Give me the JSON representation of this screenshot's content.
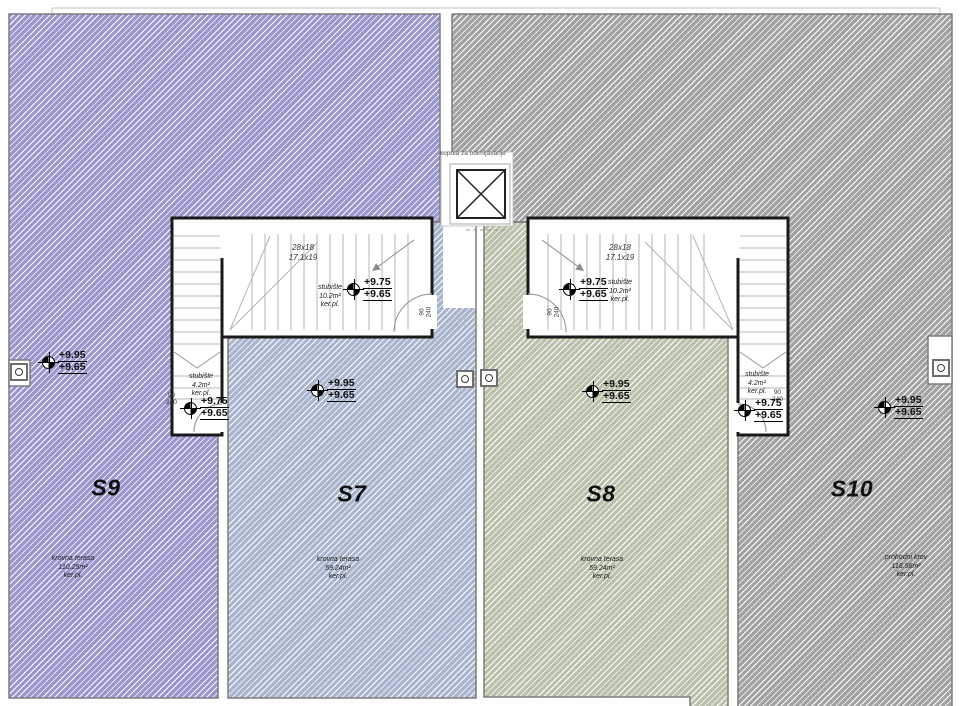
{
  "skylight": {
    "label": "kupola za odimljavanje"
  },
  "units": {
    "s9": {
      "id": "S9",
      "surface": "krovna terasa",
      "area": "110.25m²",
      "finish": "ker.pl.",
      "level_top": "+9.95",
      "level_low": "+9.65"
    },
    "s7": {
      "id": "S7",
      "surface": "krovna terasa",
      "area": "59.24m²",
      "finish": "ker.pl.",
      "level_top": "+9.95",
      "level_low": "+9.65"
    },
    "s8": {
      "id": "S8",
      "surface": "krovna terasa",
      "area": "59.24m²",
      "finish": "ker.pl.",
      "level_top": "+9.95",
      "level_low": "+9.65"
    },
    "s10": {
      "id": "S10",
      "surface": "prohodni krov",
      "area": "118.56m²",
      "finish": "ker.pl.",
      "level_top": "+9.95",
      "level_low": "+9.65"
    }
  },
  "stair_main": {
    "room": "stubište",
    "area": "10.2m²",
    "finish": "ker.pl.",
    "risers": "28x18",
    "run": "17.1x19",
    "level_top": "+9.75",
    "level_low": "+9.65",
    "door_width": "90",
    "door_height": "240"
  },
  "stair_small": {
    "room": "stubište",
    "area": "4.2m²",
    "finish": "ker.pl.",
    "level_top": "+9.75",
    "level_low": "+9.65",
    "door_width": "90",
    "door_height": "240"
  },
  "colors": {
    "s9": "#9a96cf",
    "s7": "#a9b4cd",
    "s8": "#bac1ab",
    "s10": "#a2a2a2"
  }
}
